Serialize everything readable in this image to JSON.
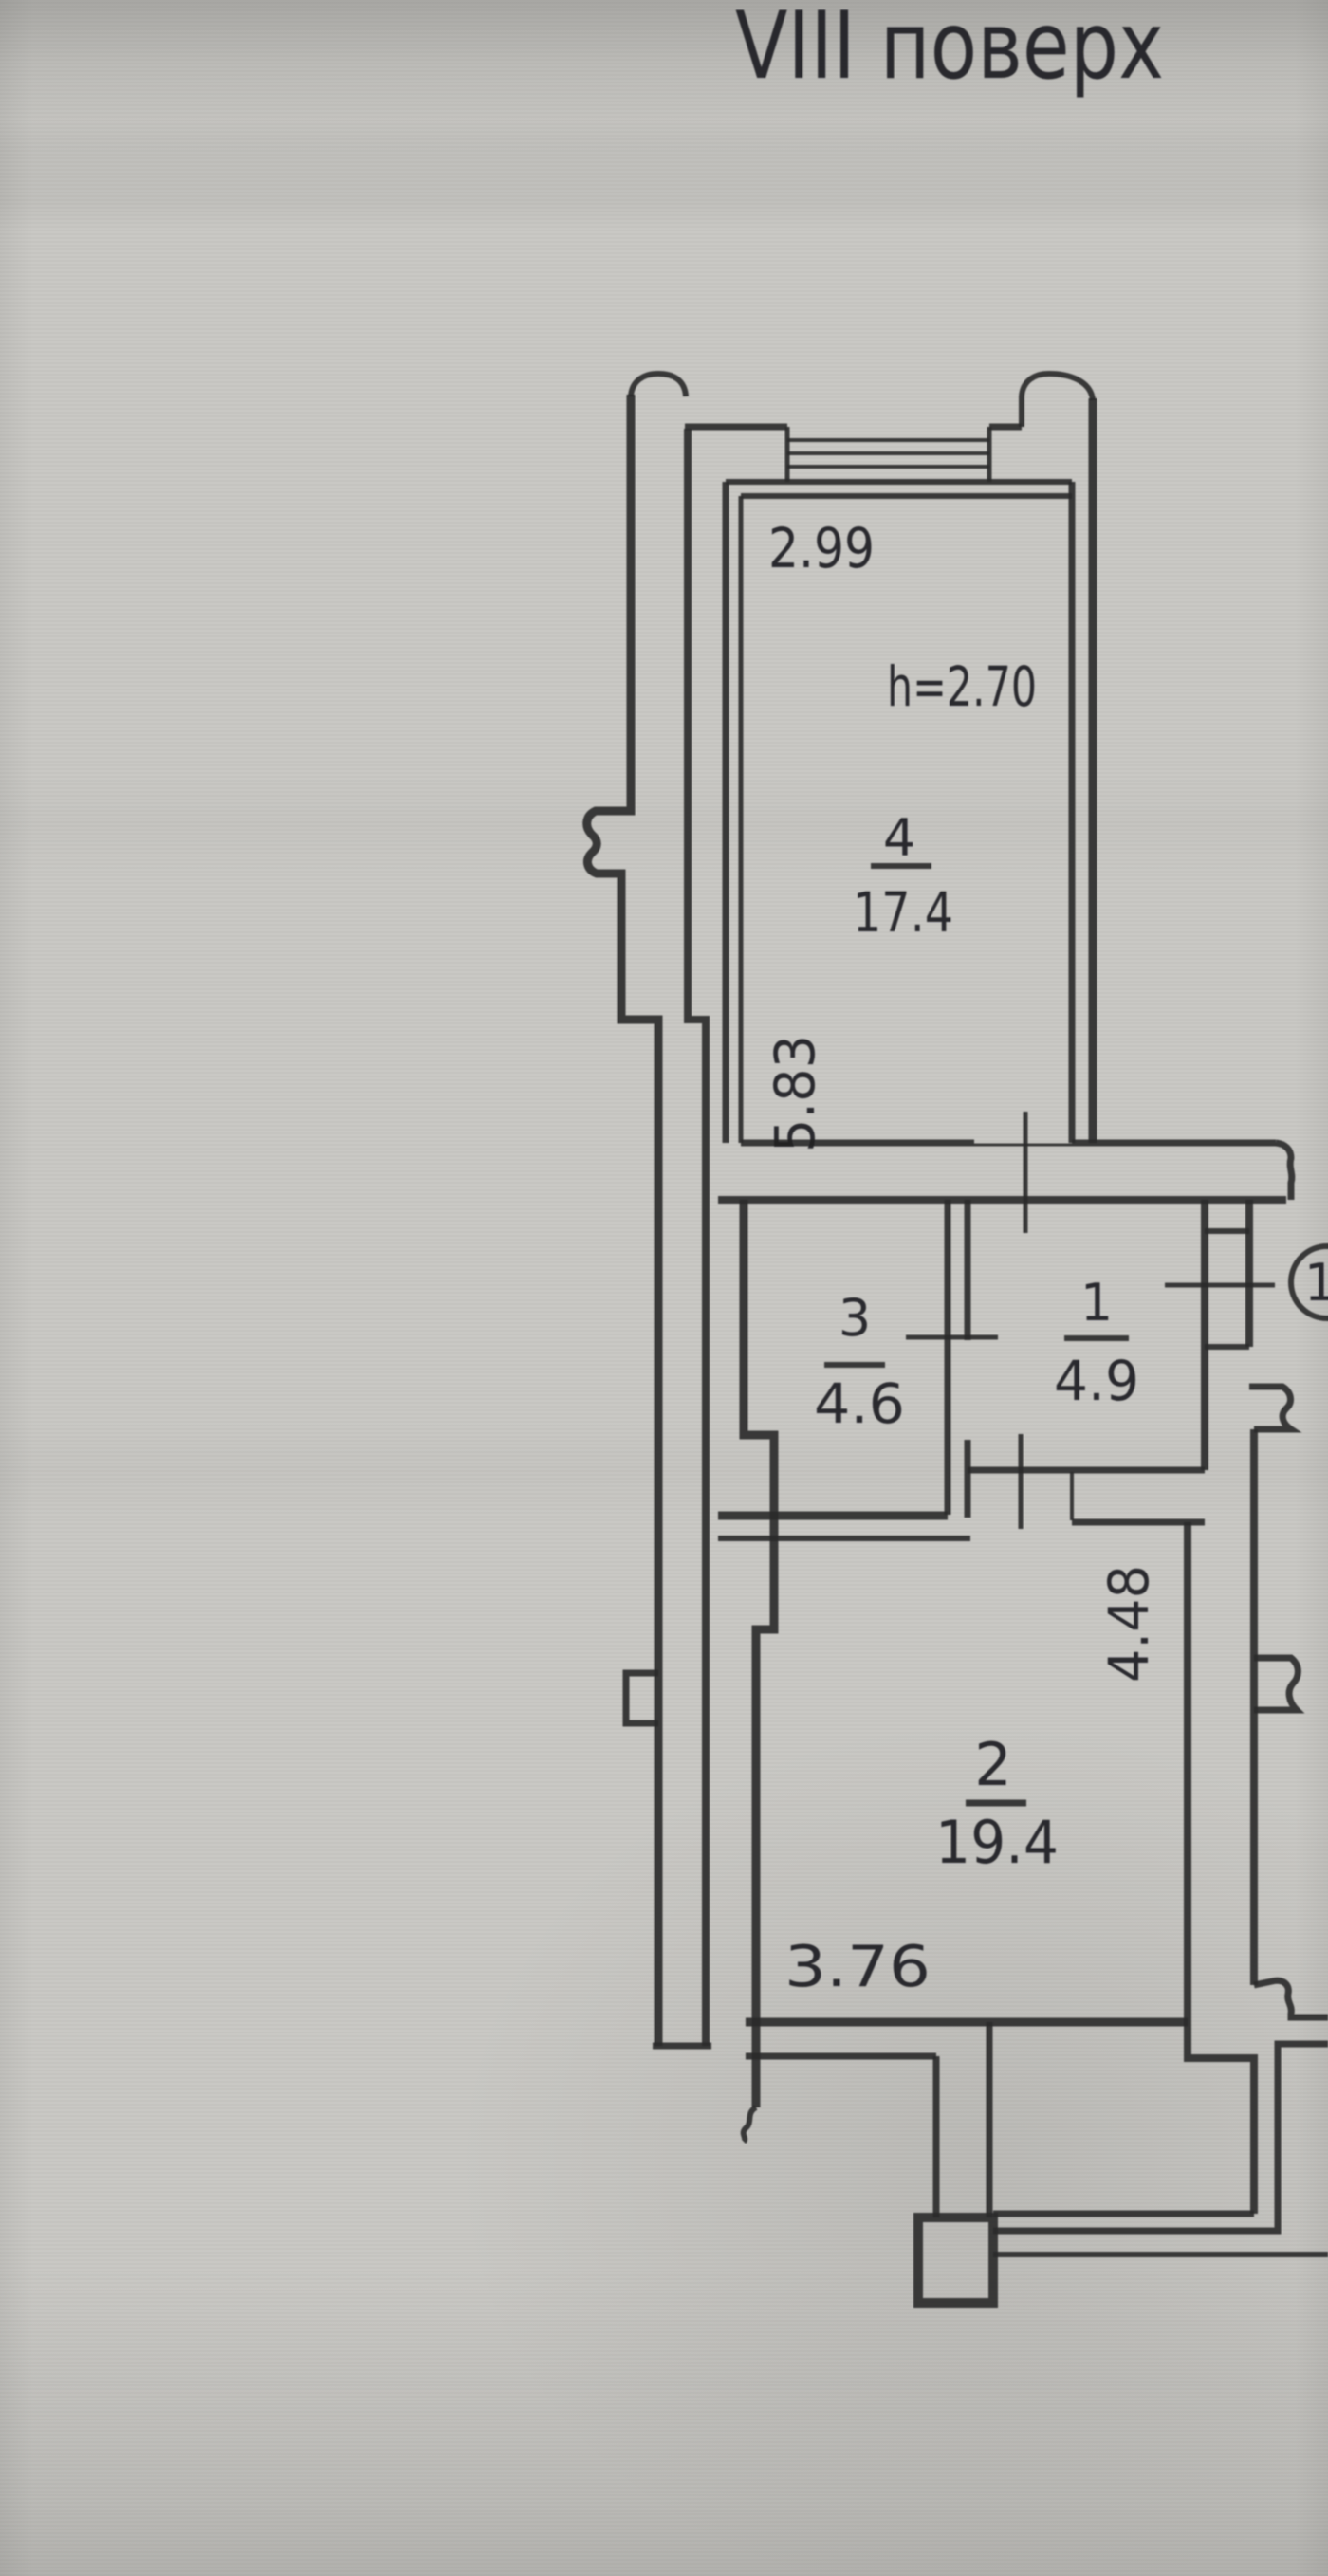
{
  "header": {
    "floor_title": "VIII  поверх"
  },
  "plan": {
    "apartment_number": "1",
    "ceiling_height": "h=2.70",
    "rooms": [
      {
        "number": "4",
        "area": "17.4",
        "width_m": "2.99",
        "depth_m": "5.83"
      },
      {
        "number": "3",
        "area": "4.6"
      },
      {
        "number": "1",
        "area": "4.9"
      },
      {
        "number": "2",
        "area": "19.4",
        "width_m": "3.76",
        "depth_m": "4.48"
      }
    ]
  },
  "colors": {
    "paper": "#c8c7c3",
    "ink": "#2a2a2c",
    "text": "#1f1f21"
  }
}
